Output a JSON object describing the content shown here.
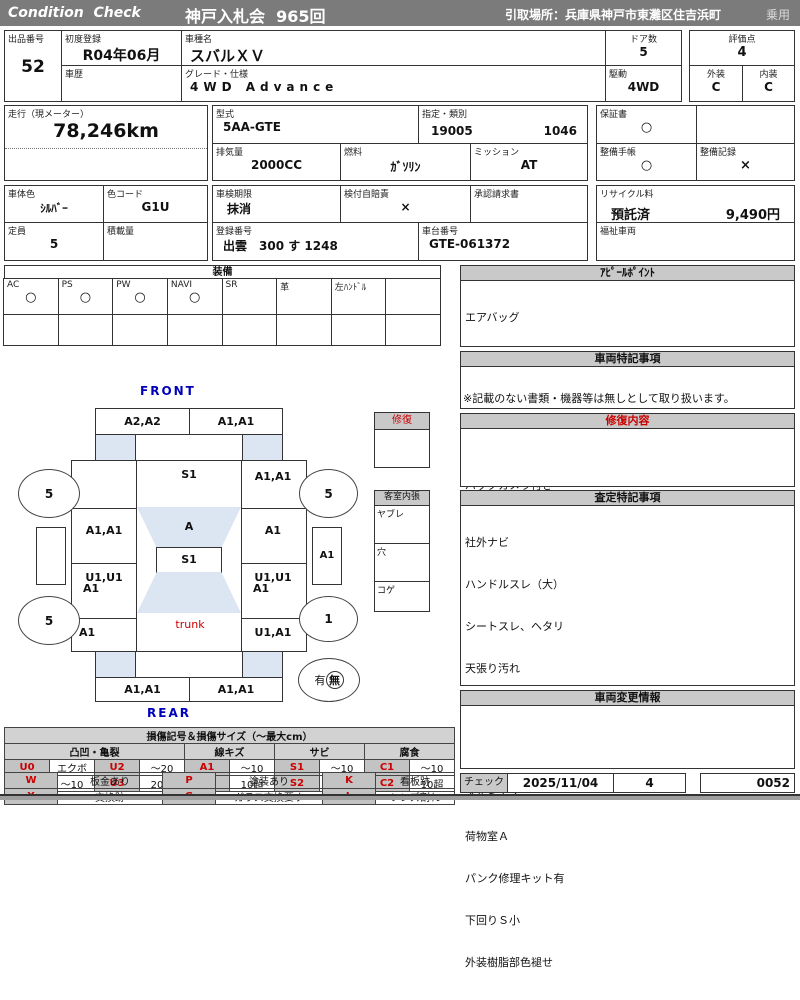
{
  "header": {
    "brand": "Condition  Check",
    "auction": "神戸入札会  965回",
    "pickup": "引取場所：兵庫県神戸市東灘区住吉浜町",
    "vehicle_class": "乗用"
  },
  "info": {
    "lot_label": "出品番号",
    "lot_value": "52",
    "first_reg_label": "初度登録",
    "first_reg_value": "R04年06月",
    "history_label": "車歴",
    "model_label": "車種名",
    "model_value": "スバルＸＶ",
    "grade_label": "グレード・仕様",
    "grade_value": "4WD Advance",
    "doors_label": "ドア数",
    "doors_value": "5",
    "drive_label": "駆動",
    "drive_value": "4WD",
    "score_label": "評価点",
    "score_value": "4",
    "exterior_label": "外装",
    "exterior_value": "C",
    "interior_label": "内装",
    "interior_value": "C",
    "mileage_label": "走行（現メーター）",
    "mileage_value": "78,246km",
    "type_label": "型式",
    "type_value": "5AA-GTE",
    "class_label": "指定・類別",
    "class_value1": "19005",
    "class_value2": "1046",
    "displacement_label": "排気量",
    "displacement_value": "2000CC",
    "fuel_label": "燃料",
    "fuel_value": "ｶﾞｿﾘﾝ",
    "mission_label": "ミッション",
    "mission_value": "AT",
    "warranty_label": "保証書",
    "warranty_value": "○",
    "book_label": "整備手帳",
    "book_value": "○",
    "record_label": "整備記録",
    "record_value": "×",
    "body_color_label": "車体色",
    "body_color_value": "ｼﾙﾊﾞｰ",
    "color_code_label": "色コード",
    "color_code_value": "G1U",
    "inspection_label": "車検期限",
    "inspection_value": "抹消",
    "insurance_label": "検付自賠責",
    "insurance_value": "×",
    "approval_label": "承認請求書",
    "registration_label": "登録番号",
    "registration_value": "出雲　300 す 1248",
    "chassis_label": "車台番号",
    "chassis_value": "GTE-061372",
    "recycle_label": "リサイクル料",
    "recycle_status": "預託済",
    "recycle_fee": "9,490円",
    "capacity_label": "定員",
    "capacity_value": "5",
    "load_label": "積載量",
    "welfare_label": "福祉車両"
  },
  "equipment": {
    "title": "装備",
    "items": [
      {
        "label": "AC",
        "value": "○"
      },
      {
        "label": "PS",
        "value": "○"
      },
      {
        "label": "PW",
        "value": "○"
      },
      {
        "label": "NAVI",
        "value": "○"
      },
      {
        "label": "SR",
        "value": ""
      },
      {
        "label": "革",
        "value": ""
      },
      {
        "label": "左ﾊﾝﾄﾞﾙ",
        "value": ""
      },
      {
        "label": "",
        "value": ""
      }
    ]
  },
  "panels": {
    "appeal": {
      "title": "ｱﾋﾟｰﾙﾎﾟｲﾝﾄ",
      "lines": [
        "エアバッグ",
        "ABS    ETC",
        "プッシュスタート",
        "フロントパワーシート",
        "バックカメラ付き"
      ]
    },
    "special": {
      "title": "車両特記事項",
      "note": "※記載のない書類・機器等は無しとして取り扱います。"
    },
    "repair": {
      "title": "修復内容"
    },
    "assessment": {
      "title": "査定特記事項",
      "lines": [
        "社外ナビ",
        "ハンドルスレ（大）",
        "シートスレ、ヘタリ",
        "天張り汚れ",
        "フロアカーペットスレ",
        "内装汚れ、キズ",
        "アルミキズ",
        "荷物室Ａ",
        "パンク修理キット有",
        "下回りＳ小",
        "外装樹脂部色褪せ"
      ]
    },
    "change_info": {
      "title": "車両変更情報"
    },
    "check": {
      "label": "チェック",
      "date": "2025/11/04",
      "value": "4",
      "code": "0052"
    }
  },
  "diagram": {
    "front_label": "FRONT",
    "rear_label": "REAR",
    "front_bumper_left": "A2,A2",
    "front_bumper_right": "A1,A1",
    "left_fender_front": "",
    "hood": "S1",
    "right_fender_front": "A1,A1",
    "left_door_front": "A1,A1",
    "windshield": "A",
    "right_door_front": "A1",
    "roof": "S1",
    "left_door_rear_1": "U1,U1",
    "left_door_rear_2": "A1",
    "right_door_rear_1": "U1,U1",
    "right_door_rear_2": "A1",
    "left_fender_rear": "A1",
    "trunk_label": "trunk",
    "right_fender_rear": "U1,A1",
    "rear_bumper_left": "A1,A1",
    "rear_bumper_right": "A1,A1",
    "wheel_front_left": "5",
    "wheel_front_right": "5",
    "wheel_rear_left": "5",
    "wheel_rear_right": "1",
    "mirror_left": "",
    "mirror_right": "A1",
    "spare_yes": "有",
    "spare_no": "無",
    "repair_box_title": "修復",
    "cabin_box_title": "客室内張",
    "cabin_row_1": "ヤブレ",
    "cabin_row_2": "穴",
    "cabin_row_3": "コゲ"
  },
  "legend": {
    "title": "損傷記号＆損傷サイズ（〜最大cm）",
    "groups": [
      "凸凹・亀裂",
      "線キズ",
      "サビ",
      "腐食"
    ],
    "rows": [
      [
        "U0",
        "エクボ",
        "U2",
        "〜20",
        "A1",
        "〜10",
        "S1",
        "〜10",
        "C1",
        "〜10"
      ],
      [
        "U1",
        "〜10",
        "U3",
        "20超",
        "A2",
        "10超",
        "S2",
        "10超",
        "C2",
        "10超"
      ]
    ],
    "codes2": [
      [
        "W",
        "板金あり",
        "P",
        "塗装あり",
        "K",
        "看板跡"
      ],
      [
        "X",
        "交換跡",
        "G",
        "ガラス交換要す",
        "L",
        "レンズ割れ"
      ]
    ]
  },
  "colors": {
    "titlebar_bg": "#7b7b7b",
    "section_header_bg": "#c9c9c9",
    "glass_blue": "#dce6f2",
    "red": "#cc0000",
    "blue": "#0000bb"
  }
}
